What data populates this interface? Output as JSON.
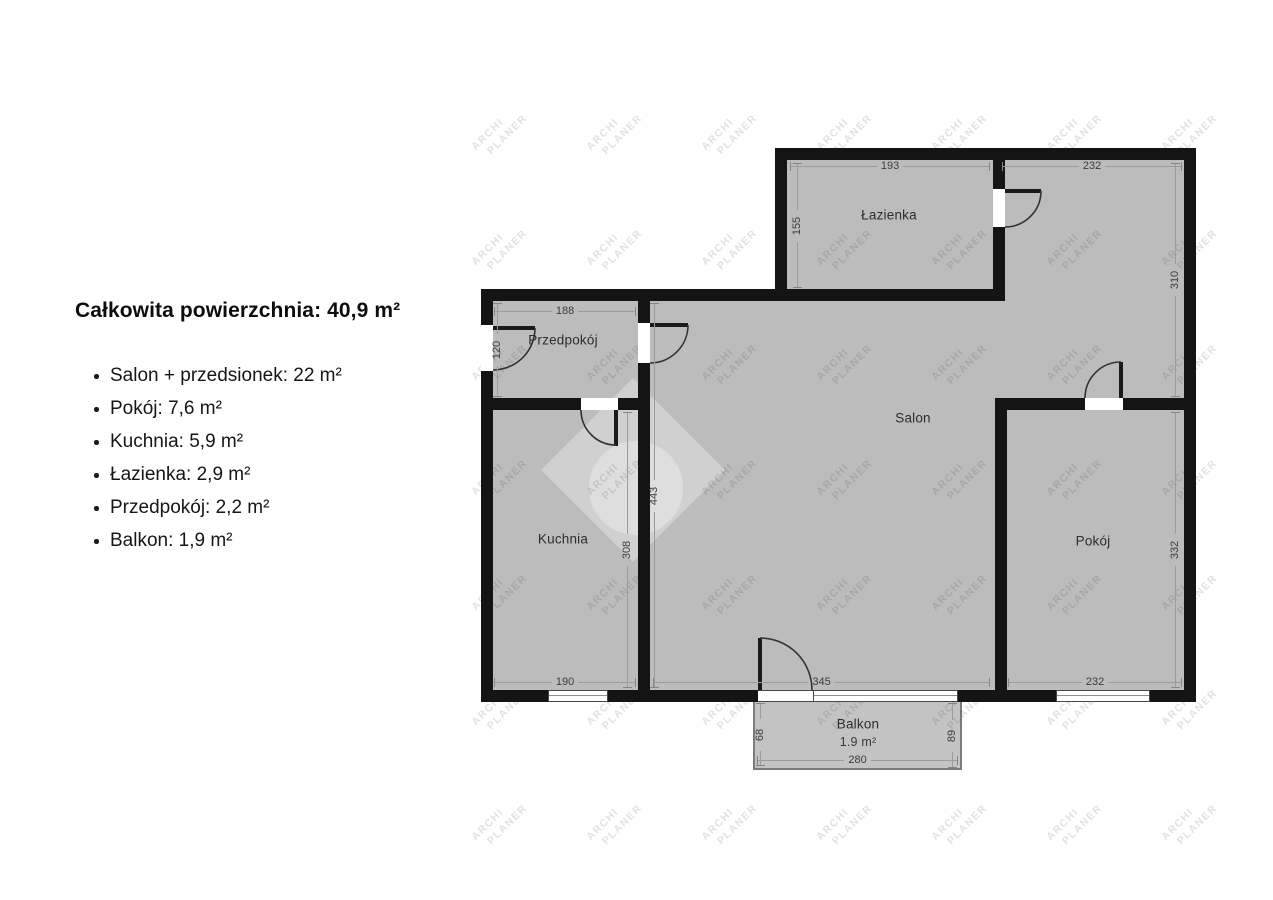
{
  "summary": {
    "title": "Całkowita powierzchnia: 40,9 m²",
    "items": [
      "Salon + przedsionek: 22 m²",
      "Pokój: 7,6 m²",
      "Kuchnia: 5,9 m²",
      "Łazienka: 2,9 m²",
      "Przedpokój: 2,2 m²",
      "Balkon: 1,9 m²"
    ]
  },
  "plan": {
    "rooms": {
      "lazienka": "Łazienka",
      "przedpokoj": "Przedpokój",
      "salon": "Salon",
      "kuchnia": "Kuchnia",
      "pokoj": "Pokój",
      "balkon_name": "Balkon",
      "balkon_area": "1.9 m²"
    },
    "dims": {
      "lazienka_top": "193",
      "salon_top": "232",
      "lazienka_left": "155",
      "right_upper": "310",
      "przedpokoj_top": "188",
      "przedpokoj_left": "120",
      "salon_left": "443",
      "kuchnia_right": "308",
      "kuchnia_bottom": "190",
      "salon_bottom": "345",
      "pokoj_bottom": "232",
      "pokoj_right": "332",
      "balkon_left": "68",
      "balkon_right": "89",
      "balkon_bottom": "280"
    }
  },
  "watermark": {
    "line1": "ARCHI",
    "line2": "PLANER"
  },
  "colors": {
    "wall": "#141414",
    "room_fill": "#bcbcbc",
    "dim_text": "#3c3c3c",
    "text": "#111111",
    "background": "#ffffff"
  }
}
